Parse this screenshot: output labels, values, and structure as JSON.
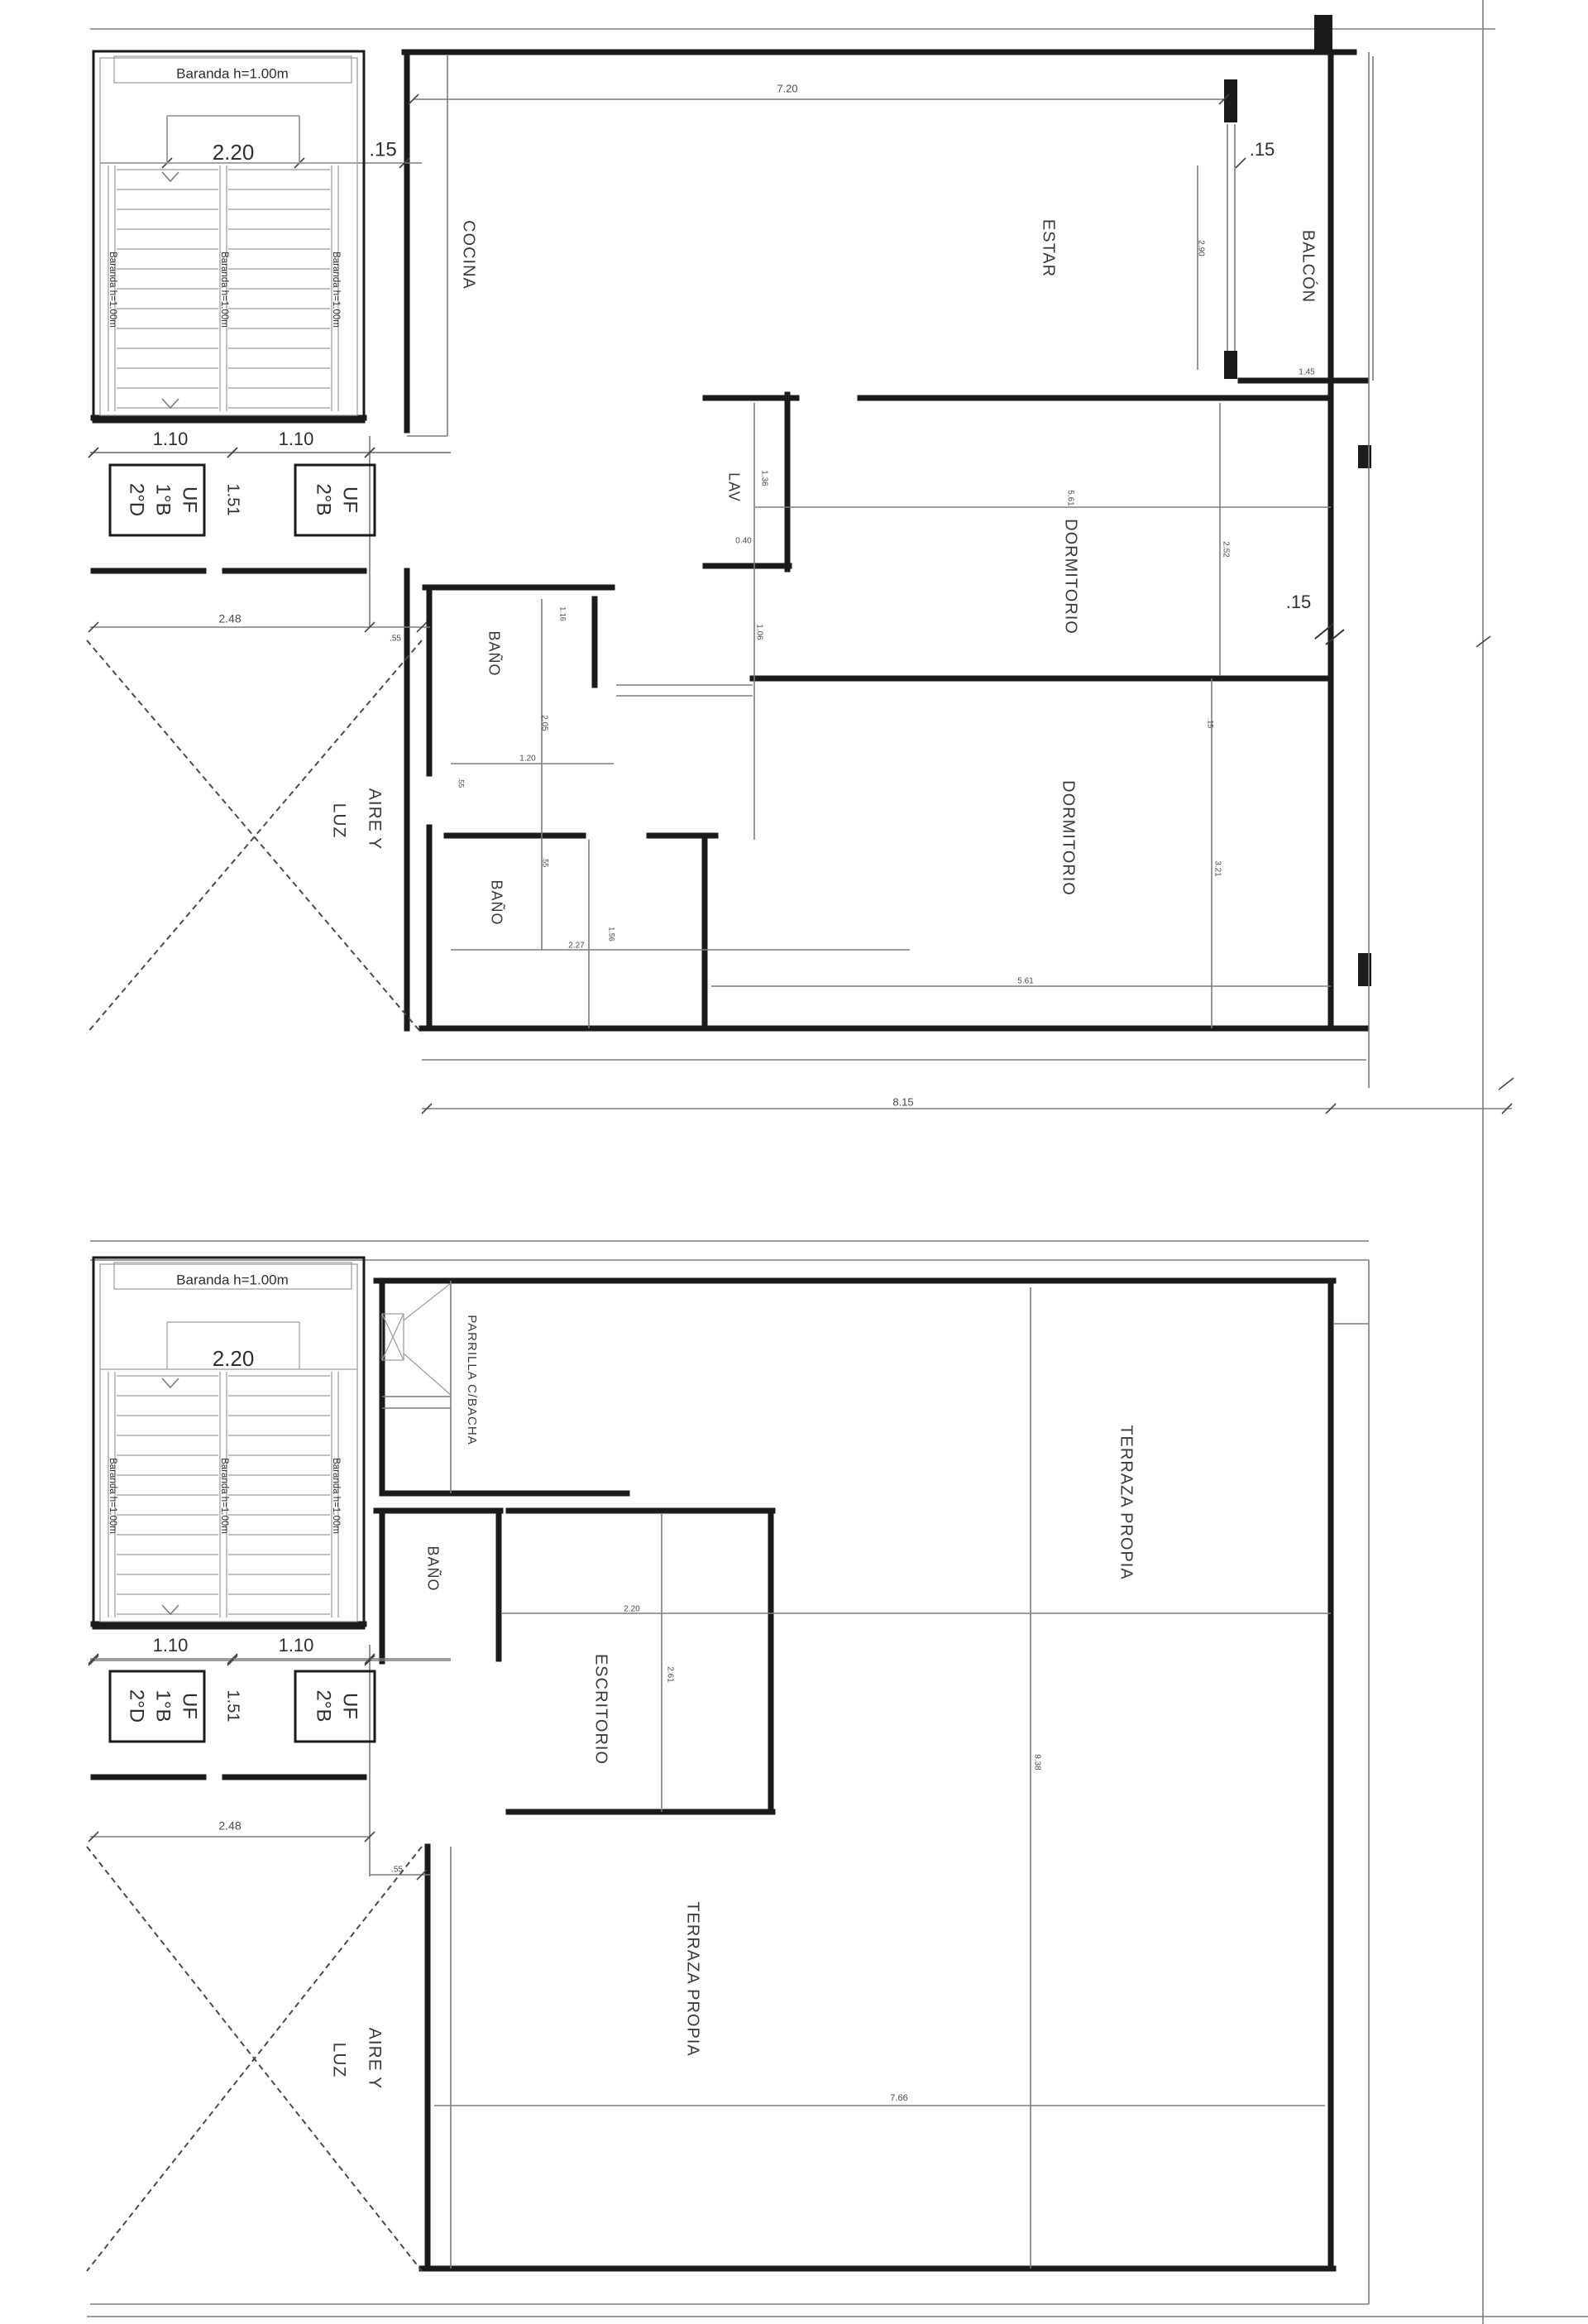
{
  "colors": {
    "wall": "#1b1b1b",
    "thin_line": "#7d7d7d",
    "text": "#2f2f2f",
    "dim_text": "#4a4a4a"
  },
  "plan_top": {
    "stair": {
      "header": "Baranda h=1.00m",
      "rail": "Baranda h=1.00m",
      "width": "2.20",
      "wall_dim": ".15",
      "flight_left": "1.10",
      "flight_right": "1.10",
      "center_dim": "1.51",
      "uf_left": [
        "UF",
        "1°B",
        "2°D"
      ],
      "uf_right": [
        "UF",
        "2°B"
      ],
      "block_width": "2.48",
      "gap_dim": ".55"
    },
    "rooms": {
      "cocina": "COCINA",
      "estar": "ESTAR",
      "balcon": "BALCÓN",
      "lav": "LAV",
      "dormitorio_1": "DORMITORIO",
      "dormitorio_2": "DORMITORIO",
      "bano_1": "BAÑO",
      "bano_2": "BAÑO",
      "aire_line1": "AIRE Y",
      "aire_line2": "LUZ"
    },
    "dims": {
      "top_width": "7.20",
      "balcon_wall": ".15",
      "balcon_height": "2.90",
      "balcon_bottom": "1.45",
      "lav_height": "1.36",
      "lav_width": "0.40",
      "lav_door": "1.06",
      "dorm1_width": "5.61",
      "dorm1_height": "2.52",
      "dorm_wall": ".15",
      "dorm2_wall": ".15",
      "dorm2_height": "3.21",
      "dorm2_width": "5.61",
      "bano1_width": "1.16",
      "bano1_height": "2.05",
      "bano1_door": "1.20",
      "bano1_side": ".55",
      "bano2_side": ".55",
      "bano2_width": "2.27",
      "bano2_height": "1.56",
      "bottom_width": "8.15"
    }
  },
  "plan_bottom": {
    "stair": {
      "header": "Baranda h=1.00m",
      "rail": "Baranda h=1.00m",
      "width": "2.20",
      "flight_left": "1.10",
      "flight_right": "1.10",
      "center_dim": "1.51",
      "uf_left": [
        "UF",
        "1°B",
        "2°D"
      ],
      "uf_right": [
        "UF",
        "2°B"
      ],
      "block_width": "2.48",
      "gap_dim": ".55"
    },
    "rooms": {
      "parrilla": "PARRILLA C/BACHA",
      "bano": "BAÑO",
      "escritorio": "ESCRITORIO",
      "terraza_1": "TERRAZA PROPIA",
      "terraza_2": "TERRAZA PROPIA",
      "aire_line1": "AIRE Y",
      "aire_line2": "LUZ"
    },
    "dims": {
      "escritorio_width": "2.20",
      "escritorio_height": "2.61",
      "terraza_height": "9.38",
      "terraza_width": "7.66"
    }
  }
}
